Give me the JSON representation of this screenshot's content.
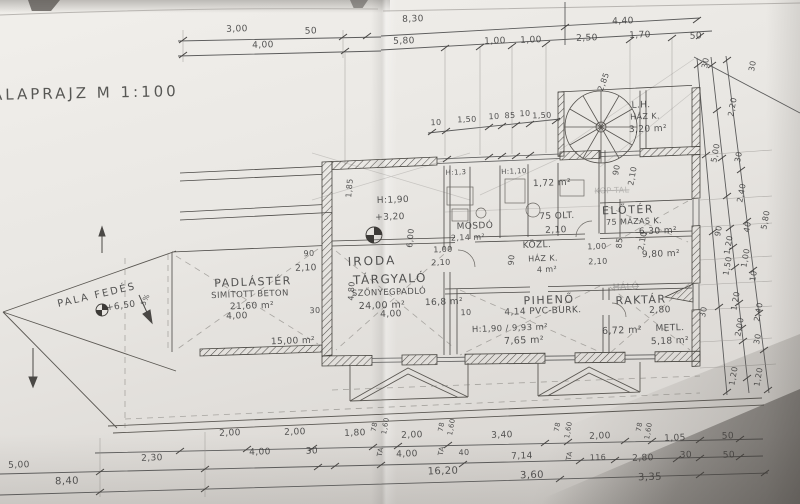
{
  "title": "ALAPRAJZ M 1:100",
  "labels": [
    {
      "t": "3,00",
      "x": 237,
      "y": 30
    },
    {
      "t": "50",
      "x": 311,
      "y": 32
    },
    {
      "t": "4,00",
      "x": 263,
      "y": 46
    },
    {
      "t": "8,30",
      "x": 413,
      "y": 20
    },
    {
      "t": "5,80",
      "x": 404,
      "y": 42
    },
    {
      "t": "4,40",
      "x": 623,
      "y": 22
    },
    {
      "t": "1,00",
      "x": 495,
      "y": 42
    },
    {
      "t": "1,00",
      "x": 531,
      "y": 41
    },
    {
      "t": "2,50",
      "x": 587,
      "y": 39
    },
    {
      "t": "1,70",
      "x": 640,
      "y": 36
    },
    {
      "t": "50",
      "x": 696,
      "y": 37
    },
    {
      "t": "10",
      "x": 436,
      "y": 123,
      "s": 8
    },
    {
      "t": "1,50",
      "x": 467,
      "y": 120,
      "s": 8
    },
    {
      "t": "10",
      "x": 494,
      "y": 117,
      "s": 8
    },
    {
      "t": "85",
      "x": 510,
      "y": 116,
      "s": 8
    },
    {
      "t": "10",
      "x": 525,
      "y": 114,
      "s": 8
    },
    {
      "t": "1,50",
      "x": 542,
      "y": 116,
      "s": 8
    },
    {
      "t": "2,85",
      "x": 604,
      "y": 82,
      "s": 8,
      "r": -70
    },
    {
      "t": "L.H.",
      "x": 641,
      "y": 106,
      "n": "room-label"
    },
    {
      "t": "HÁZ K.",
      "x": 645,
      "y": 117,
      "s": 8
    },
    {
      "t": "3,20 m²",
      "x": 648,
      "y": 130
    },
    {
      "t": "90",
      "x": 617,
      "y": 170,
      "r": -80,
      "s": 8
    },
    {
      "t": "2,10",
      "x": 633,
      "y": 176,
      "r": -80,
      "s": 8
    },
    {
      "t": "KOP-TAL",
      "x": 612,
      "y": 191,
      "s": 8,
      "o": 0.28,
      "st": 1
    },
    {
      "t": "1,85",
      "x": 350,
      "y": 188,
      "r": -85,
      "s": 8
    },
    {
      "t": "H:1,90",
      "x": 393,
      "y": 201
    },
    {
      "t": "+3,20",
      "x": 390,
      "y": 218
    },
    {
      "t": "6,00",
      "x": 411,
      "y": 238,
      "r": -85,
      "s": 8
    },
    {
      "t": "90",
      "x": 309,
      "y": 254,
      "s": 8
    },
    {
      "t": "2,10",
      "x": 306,
      "y": 269
    },
    {
      "t": "30",
      "x": 315,
      "y": 311,
      "s": 8
    },
    {
      "t": "4,80",
      "x": 352,
      "y": 291,
      "r": -87,
      "s": 8
    },
    {
      "t": "PALA FEDÉS",
      "x": 97,
      "y": 296,
      "r": -13,
      "s": 10,
      "ls": 2,
      "n": "room-label"
    },
    {
      "t": "+6,50",
      "x": 121,
      "y": 307,
      "r": -8
    },
    {
      "t": "5%",
      "x": 146,
      "y": 300,
      "r": -65,
      "s": 7
    },
    {
      "t": "PADLÁSTÉR",
      "x": 253,
      "y": 282,
      "s": 11,
      "ls": 1.5,
      "n": "room-label"
    },
    {
      "t": "SIMÍTOTT BETON",
      "x": 250,
      "y": 295,
      "s": 8.5
    },
    {
      "t": "21,60 m²",
      "x": 252,
      "y": 307
    },
    {
      "t": "4,00",
      "x": 237,
      "y": 317
    },
    {
      "t": "15,00 m²",
      "x": 293,
      "y": 342
    },
    {
      "t": "IRODA",
      "x": 372,
      "y": 261,
      "s": 12,
      "ls": 2,
      "n": "room-label"
    },
    {
      "t": "TÁRGYALÓ",
      "x": 390,
      "y": 279,
      "s": 12,
      "ls": 1.5,
      "n": "room-label"
    },
    {
      "t": "SZŐNYEGPADLÓ",
      "x": 389,
      "y": 293,
      "s": 8.5
    },
    {
      "t": "24,00 m²",
      "x": 382,
      "y": 306,
      "s": 9.5
    },
    {
      "t": "4,00",
      "x": 391,
      "y": 315
    },
    {
      "t": "16,8 m²",
      "x": 444,
      "y": 303
    },
    {
      "t": "H:1,3",
      "x": 456,
      "y": 173,
      "s": 7
    },
    {
      "t": "H:1,10",
      "x": 514,
      "y": 172,
      "s": 7
    },
    {
      "t": "MOSDÓ",
      "x": 475,
      "y": 227,
      "n": "room-label"
    },
    {
      "t": "2,14 m²",
      "x": 468,
      "y": 238,
      "s": 8
    },
    {
      "t": "1,72 m²",
      "x": 552,
      "y": 184
    },
    {
      "t": "75 OLT.",
      "x": 557,
      "y": 217
    },
    {
      "t": "2,10",
      "x": 556,
      "y": 231
    },
    {
      "t": "1,00",
      "x": 443,
      "y": 250,
      "s": 8
    },
    {
      "t": "2,10",
      "x": 441,
      "y": 263,
      "s": 8
    },
    {
      "t": "90",
      "x": 512,
      "y": 260,
      "r": -85,
      "s": 8
    },
    {
      "t": "KÖZL.",
      "x": 537,
      "y": 246,
      "n": "room-label"
    },
    {
      "t": "HÁZ K.",
      "x": 543,
      "y": 259,
      "s": 8
    },
    {
      "t": "4 m²",
      "x": 547,
      "y": 270,
      "s": 8
    },
    {
      "t": "1,00",
      "x": 597,
      "y": 247,
      "s": 8
    },
    {
      "t": "2,10",
      "x": 598,
      "y": 262,
      "s": 8
    },
    {
      "t": "85",
      "x": 620,
      "y": 243,
      "r": -85,
      "s": 8
    },
    {
      "t": "ELŐTÉR",
      "x": 628,
      "y": 210,
      "s": 11,
      "ls": 1.5,
      "n": "room-label"
    },
    {
      "t": "75 MÁZAS K.",
      "x": 634,
      "y": 222,
      "s": 8
    },
    {
      "t": "6,30 m²",
      "x": 658,
      "y": 232
    },
    {
      "t": "2,10",
      "x": 643,
      "y": 241,
      "r": -80,
      "s": 8
    },
    {
      "t": "9,80 m²",
      "x": 661,
      "y": 255
    },
    {
      "t": "PIHENŐ",
      "x": 549,
      "y": 300,
      "s": 11,
      "ls": 1.5,
      "n": "room-label"
    },
    {
      "t": "10",
      "x": 466,
      "y": 313,
      "s": 8
    },
    {
      "t": "4,14  PVC-BURK.",
      "x": 543,
      "y": 312
    },
    {
      "t": "H:1,90 / 9,93 m²",
      "x": 510,
      "y": 329,
      "s": 8.5
    },
    {
      "t": "7,65 m²",
      "x": 524,
      "y": 341,
      "s": 9.5
    },
    {
      "t": "HÁLÓ",
      "x": 626,
      "y": 288,
      "o": 0.35,
      "st": 1
    },
    {
      "t": "RAKTÁR",
      "x": 641,
      "y": 300,
      "s": 11,
      "ls": 1.5,
      "n": "room-label"
    },
    {
      "t": "2,80",
      "x": 660,
      "y": 311
    },
    {
      "t": "6,72 m²",
      "x": 622,
      "y": 331,
      "s": 9.5
    },
    {
      "t": "METL.",
      "x": 670,
      "y": 329
    },
    {
      "t": "5,18 m²",
      "x": 670,
      "y": 342
    },
    {
      "t": "30",
      "x": 704,
      "y": 312,
      "r": -80,
      "s": 8
    },
    {
      "t": "30",
      "x": 706,
      "y": 63,
      "r": -80,
      "s": 8
    },
    {
      "t": "30",
      "x": 753,
      "y": 66,
      "r": -80,
      "s": 8
    },
    {
      "t": "2,20",
      "x": 733,
      "y": 107,
      "r": -80,
      "s": 8
    },
    {
      "t": "5,00",
      "x": 716,
      "y": 153,
      "r": -80,
      "s": 8
    },
    {
      "t": "30",
      "x": 739,
      "y": 157,
      "r": -80,
      "s": 8
    },
    {
      "t": "2,40",
      "x": 742,
      "y": 193,
      "r": -80,
      "s": 8
    },
    {
      "t": "5,80",
      "x": 766,
      "y": 220,
      "r": -80,
      "s": 8
    },
    {
      "t": "90",
      "x": 719,
      "y": 231,
      "r": -80,
      "s": 8
    },
    {
      "t": "40",
      "x": 748,
      "y": 227,
      "r": -80,
      "s": 8
    },
    {
      "t": "1,20",
      "x": 729,
      "y": 245,
      "r": -80,
      "s": 8
    },
    {
      "t": "1,00",
      "x": 746,
      "y": 258,
      "r": -80,
      "s": 8
    },
    {
      "t": "1,50",
      "x": 728,
      "y": 266,
      "r": -80,
      "s": 8
    },
    {
      "t": "10",
      "x": 754,
      "y": 276,
      "r": -80,
      "s": 8
    },
    {
      "t": "1,20",
      "x": 736,
      "y": 301,
      "r": -80,
      "s": 8
    },
    {
      "t": "2,40",
      "x": 759,
      "y": 312,
      "r": -80,
      "s": 8
    },
    {
      "t": "2,00",
      "x": 740,
      "y": 327,
      "r": -80,
      "s": 8
    },
    {
      "t": "30",
      "x": 758,
      "y": 339,
      "r": -80,
      "s": 8
    },
    {
      "t": "1,20",
      "x": 734,
      "y": 376,
      "r": -80,
      "s": 8
    },
    {
      "t": "1,20",
      "x": 759,
      "y": 377,
      "r": -80,
      "s": 8
    },
    {
      "t": "2,00",
      "x": 230,
      "y": 434
    },
    {
      "t": "2,00",
      "x": 295,
      "y": 433
    },
    {
      "t": "1,80",
      "x": 355,
      "y": 434
    },
    {
      "t": "78",
      "x": 375,
      "y": 427,
      "r": -80,
      "s": 7
    },
    {
      "t": "1,60",
      "x": 386,
      "y": 426,
      "r": -80,
      "s": 7
    },
    {
      "t": "2,00",
      "x": 412,
      "y": 436
    },
    {
      "t": "78",
      "x": 442,
      "y": 427,
      "r": -80,
      "s": 7
    },
    {
      "t": "1,60",
      "x": 452,
      "y": 427,
      "r": -80,
      "s": 7
    },
    {
      "t": "3,40",
      "x": 502,
      "y": 436
    },
    {
      "t": "78",
      "x": 558,
      "y": 427,
      "r": -80,
      "s": 7
    },
    {
      "t": "1,60",
      "x": 569,
      "y": 430,
      "r": -80,
      "s": 7
    },
    {
      "t": "2,00",
      "x": 600,
      "y": 437
    },
    {
      "t": "78",
      "x": 640,
      "y": 427,
      "r": -80,
      "s": 7
    },
    {
      "t": "1,60",
      "x": 649,
      "y": 431,
      "r": -80,
      "s": 7
    },
    {
      "t": "1,05",
      "x": 675,
      "y": 439
    },
    {
      "t": "50",
      "x": 728,
      "y": 437
    },
    {
      "t": "4,00",
      "x": 260,
      "y": 453
    },
    {
      "t": "30",
      "x": 312,
      "y": 452
    },
    {
      "t": "TA",
      "x": 381,
      "y": 452,
      "r": -80,
      "s": 7
    },
    {
      "t": "4,00",
      "x": 407,
      "y": 455
    },
    {
      "t": "TA",
      "x": 442,
      "y": 451,
      "r": -80,
      "s": 7
    },
    {
      "t": "40",
      "x": 464,
      "y": 453,
      "s": 8
    },
    {
      "t": "7,14",
      "x": 522,
      "y": 457
    },
    {
      "t": "TA",
      "x": 570,
      "y": 456,
      "r": -80,
      "s": 7
    },
    {
      "t": "116",
      "x": 598,
      "y": 458,
      "s": 8
    },
    {
      "t": "2,80",
      "x": 643,
      "y": 459
    },
    {
      "t": "30",
      "x": 686,
      "y": 456
    },
    {
      "t": "50",
      "x": 729,
      "y": 456
    },
    {
      "t": "16,20",
      "x": 443,
      "y": 472,
      "s": 10
    },
    {
      "t": "3,60",
      "x": 532,
      "y": 476,
      "s": 10
    },
    {
      "t": "3,35",
      "x": 650,
      "y": 478,
      "s": 10
    },
    {
      "t": "5,00",
      "x": 19,
      "y": 466
    },
    {
      "t": "2,30",
      "x": 152,
      "y": 459
    },
    {
      "t": "8,40",
      "x": 67,
      "y": 482,
      "s": 10
    }
  ]
}
